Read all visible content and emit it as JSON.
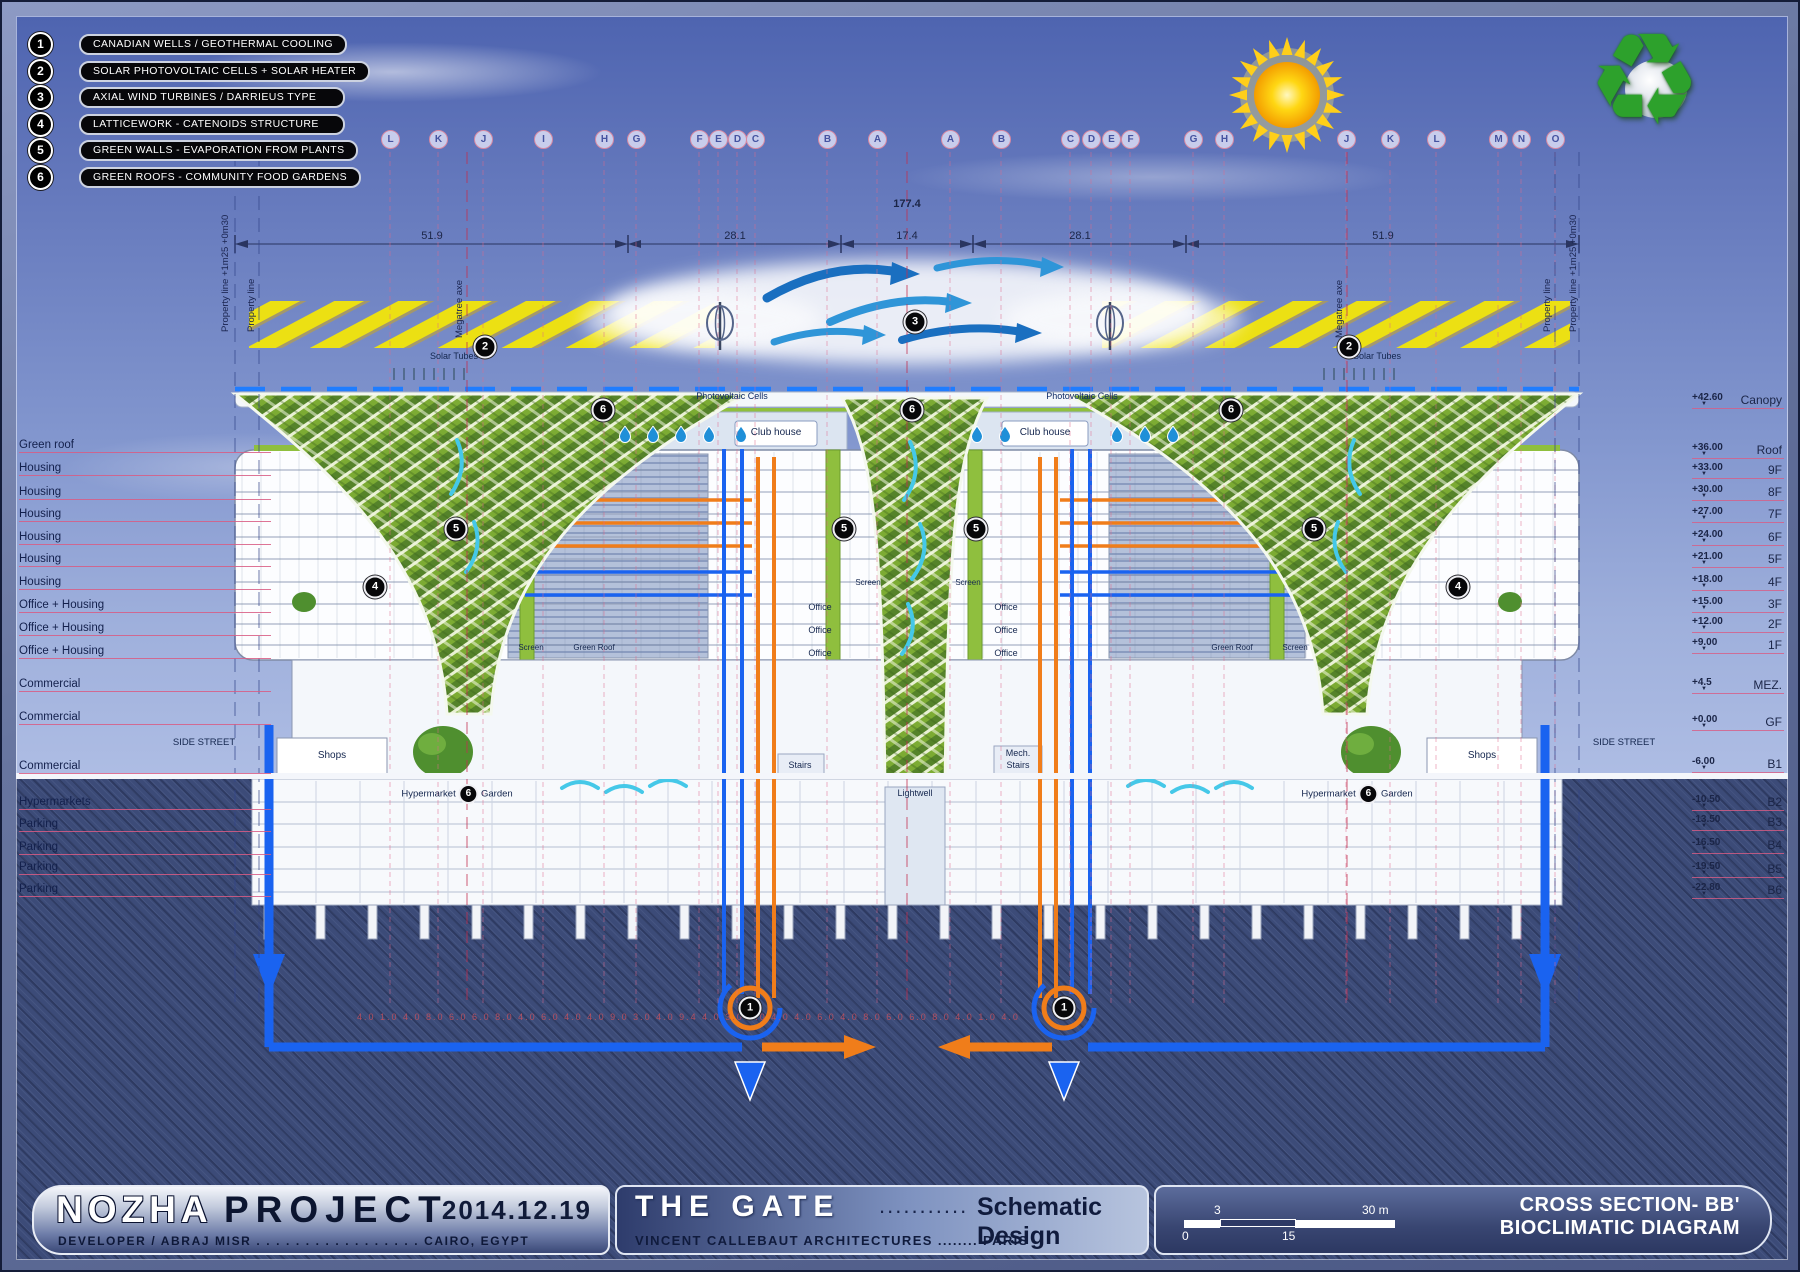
{
  "legend": {
    "items": [
      {
        "num": "1",
        "label": "CANADIAN WELLS / GEOTHERMAL COOLING"
      },
      {
        "num": "2",
        "label": "SOLAR PHOTOVOLTAIC CELLS + SOLAR HEATER"
      },
      {
        "num": "3",
        "label": "AXIAL WIND TURBINES / DARRIEUS TYPE"
      },
      {
        "num": "4",
        "label": "LATTICEWORK - CATENOIDS STRUCTURE"
      },
      {
        "num": "5",
        "label": "GREEN WALLS - EVAPORATION FROM PLANTS"
      },
      {
        "num": "6",
        "label": "GREEN ROOFS - COMMUNITY FOOD GARDENS"
      }
    ]
  },
  "grid": {
    "left_letters": [
      "L",
      "K",
      "J",
      "I",
      "H",
      "G",
      "F",
      "E",
      "D",
      "C",
      "B",
      "A"
    ],
    "right_letters": [
      "A",
      "B",
      "C",
      "D",
      "E",
      "F",
      "G",
      "H",
      "J",
      "K",
      "L",
      "M",
      "N",
      "O"
    ]
  },
  "dimensions": {
    "total": "177.4",
    "segments": [
      "51.9",
      "28.1",
      "17.4",
      "28.1",
      "51.9"
    ],
    "bottom_row": "4.0 1.0 4.0    8.0    6.0    6.0    8.0    4.0    6.0    4.0 4.0    9.0    3.0 4.0    9.4    4.0 3.0    9.0    4.0 4.0    6.0    4.0    8.0    6.0    6.0    8.0    4.0 1.0 4.0"
  },
  "site": {
    "property_line_offset": "Property line +1m25 +0m30",
    "property_line": "Property line",
    "megatree_axe": "Megatree axe",
    "solar_tubes": "Solar Tubes",
    "photovoltaic_cells": "Photovoltaic Cells",
    "side_street": "SIDE STREET"
  },
  "floors_left": [
    "Green roof",
    "Housing",
    "Housing",
    "Housing",
    "Housing",
    "Housing",
    "Housing",
    "Office + Housing",
    "Office + Housing",
    "Office + Housing",
    "Commercial",
    "Commercial",
    "Commercial",
    "Hypermarkets",
    "Parking",
    "Parking",
    "Parking",
    "Parking"
  ],
  "levels": [
    {
      "elev": "+42.60",
      "name": "Canopy"
    },
    {
      "elev": "+36.00",
      "name": "Roof"
    },
    {
      "elev": "+33.00",
      "name": "9F"
    },
    {
      "elev": "+30.00",
      "name": "8F"
    },
    {
      "elev": "+27.00",
      "name": "7F"
    },
    {
      "elev": "+24.00",
      "name": "6F"
    },
    {
      "elev": "+21.00",
      "name": "5F"
    },
    {
      "elev": "+18.00",
      "name": "4F"
    },
    {
      "elev": "+15.00",
      "name": "3F"
    },
    {
      "elev": "+12.00",
      "name": "2F"
    },
    {
      "elev": "+9.00",
      "name": "1F"
    },
    {
      "elev": "+4.5",
      "name": "MEZ."
    },
    {
      "elev": "+0.00",
      "name": "GF"
    },
    {
      "elev": "-6.00",
      "name": "B1"
    },
    {
      "elev": "-10.50",
      "name": "B2"
    },
    {
      "elev": "-13.50",
      "name": "B3"
    },
    {
      "elev": "-16.50",
      "name": "B4"
    },
    {
      "elev": "-19.50",
      "name": "B5"
    },
    {
      "elev": "-22.80",
      "name": "B6"
    }
  ],
  "drawing_markers": [
    "2",
    "2",
    "3",
    "6",
    "6",
    "6",
    "5",
    "5",
    "5",
    "5",
    "4",
    "4",
    "1",
    "1"
  ],
  "building_labels": {
    "club_house": "Club house",
    "office": "Office",
    "screen": "Screen",
    "green_roof": "Green Roof",
    "shops": "Shops",
    "hypermarket": "Hypermarket",
    "garden": "Garden",
    "garden_marker": "6",
    "stairs": "Stairs",
    "mech": "Mech.",
    "lightwell": "Lightwell"
  },
  "titleblock": {
    "project_name_1": "NOZHA",
    "project_name_2": "PROJECT",
    "date": "2014.12.19",
    "developer_line": "DEVELOPER / ABRAJ MISR . . . . . . . . . . . . . . . . . CAIRO, EGYPT",
    "gate_title": "THE GATE",
    "gate_dots": "...........",
    "gate_subtitle": "Schematic Design",
    "architect_line": "VINCENT CALLEBAUT ARCHITECTURES ........ PARIS",
    "sheet_title_1": "CROSS SECTION- BB'",
    "sheet_title_2": "BIOCLIMATIC DIAGRAM",
    "scale": {
      "top_left": "3",
      "top_right": "30 m",
      "bottom_left": "0",
      "bottom_mid": "15"
    }
  },
  "icons": {
    "level_marker": "▼",
    "recycle": "♻"
  },
  "colors": {
    "accent_orange": "#f07d1a",
    "pipe_blue": "#1a63f0",
    "grid_pink": "#e06a8c",
    "lattice_green": "#7cab33",
    "hatch_yellow": "#f2e50a",
    "dashed_pv_blue": "#1f7dff"
  }
}
